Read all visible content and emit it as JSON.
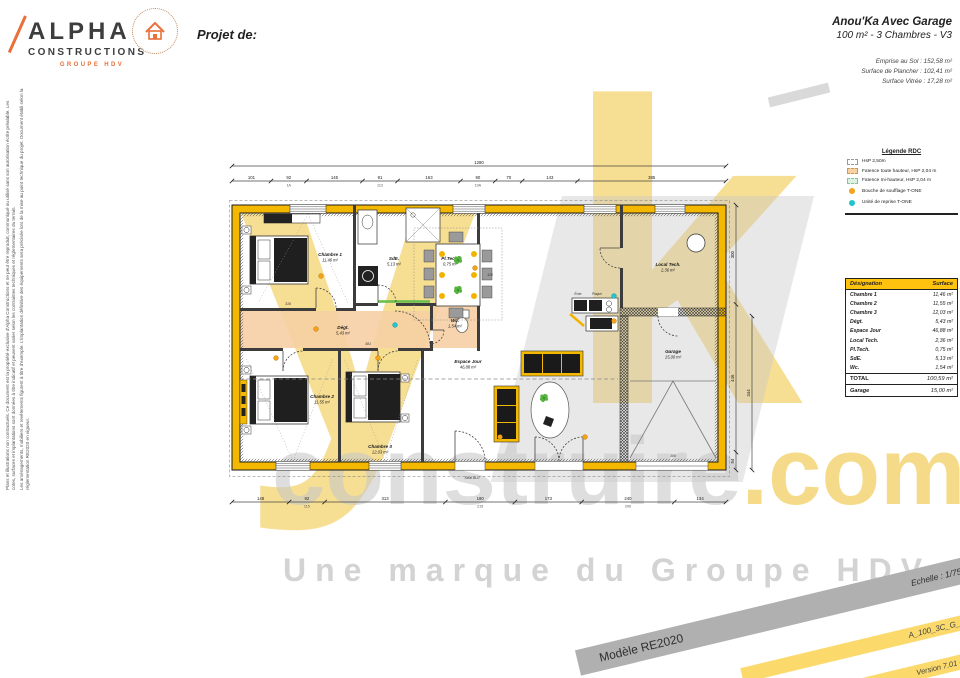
{
  "colors": {
    "wall_yellow": "#f5b800",
    "floor_orange": "#f6cfa4",
    "legend_mint": "#def2e4",
    "table_header": "#ffc20e",
    "supply_orange": "#f5a21b",
    "return_cyan": "#1fc7cd",
    "watermark_yellow": "#f0c43c",
    "watermark_gray": "#c9c9c9",
    "brand_orange": "#e8703a"
  },
  "header": {
    "logo": {
      "line1": "ALPHA",
      "line2": "CONSTRUCTIONS",
      "line3": "GROUPE HDV",
      "stamp_icon": "house"
    },
    "project_label": "Projet de:",
    "title": "Anou'Ka Avec Garage",
    "subtitle": "100 m² - 3 Chambres - V3",
    "metrics": [
      "Emprise au Sol : 152,58 m²",
      "Surface de Plancher : 102,41 m²",
      "Surface Vitrée : 17,28 m²"
    ]
  },
  "side": {
    "legal1": "Plans et illustrations non contractuels. Ce document est la propriété exclusive d'Alpha Constructions et ne peut être reproduit, communiqué ou utilisé sans son autorisation écrite préalable. Les cotes, surfaces et implantations sont données à titre indicatif et peuvent varier selon les contraintes techniques et réglementaires du terrain.",
    "legal2": "Les aménagements, mobiliers et revêtements figurent à titre d'exemple. L'implantation définitive des équipements sera précisée lors de la mise au point technique du projet. Document établi selon la réglementation RE2020 en vigueur."
  },
  "legend": {
    "title": "Légende RDC",
    "items": [
      {
        "swatch": "dash",
        "label": "HsP 2,50m"
      },
      {
        "swatch": "orange",
        "label": "Faïence toute hauteur, HsP 2,04 m"
      },
      {
        "swatch": "mint",
        "label": "Faïence mi-hauteur, HsP 2,04 m"
      },
      {
        "swatch": "dot-orange",
        "label": "Bouche de soufflage T-ONE"
      },
      {
        "swatch": "dot-cyan",
        "label": "Unité de reprise T-ONE"
      }
    ]
  },
  "table": {
    "headers": [
      "Désignation",
      "Surface"
    ],
    "rows": [
      {
        "name": "Chambre 1",
        "value": "11,46 m²"
      },
      {
        "name": "Chambre 2",
        "value": "11,55 m²"
      },
      {
        "name": "Chambre 3",
        "value": "12,03 m²"
      },
      {
        "name": "Dégt.",
        "value": "5,43 m²"
      },
      {
        "name": "Espace Jour",
        "value": "46,88 m²"
      },
      {
        "name": "Local Tech.",
        "value": "2,36 m²"
      },
      {
        "name": "Pl.Tech.",
        "value": "0,75 m²"
      },
      {
        "name": "SdE.",
        "value": "5,13 m²"
      },
      {
        "name": "Wc.",
        "value": "1,54 m²"
      }
    ],
    "total": {
      "label": "TOTAL",
      "value": "100,59 m²"
    },
    "garage": {
      "label": "Garage",
      "value": "15,00 m²"
    }
  },
  "watermark": {
    "big1": "y",
    "big2": "k",
    "mid": "construire",
    "mid_accent": ".com",
    "tagline": "Une marque du Groupe HDV"
  },
  "bands": {
    "model": "Modèle RE2020",
    "scale": "Echelle : 1/75",
    "ref": "A_100_3C_G_V3",
    "version": "Version 7.01 - Mars 2023"
  },
  "plan": {
    "rooms": [
      {
        "name": "Chambre 1",
        "area": "11,46 m²",
        "x": 102,
        "y": 108
      },
      {
        "name": "Chambre 2",
        "area": "11,55 m²",
        "x": 94,
        "y": 250
      },
      {
        "name": "Chambre 3",
        "area": "12,03 m²",
        "x": 152,
        "y": 300
      },
      {
        "name": "Dégt.",
        "area": "5,43 m²",
        "x": 115,
        "y": 181
      },
      {
        "name": "SdE.",
        "area": "5,13 m²",
        "x": 166,
        "y": 112
      },
      {
        "name": "Pl.Tech.",
        "area": "0,75 m²",
        "x": 222,
        "y": 112
      },
      {
        "name": "Wc.",
        "area": "1,54 m²",
        "x": 227,
        "y": 174
      },
      {
        "name": "Espace Jour",
        "area": "46,88 m²",
        "x": 240,
        "y": 215
      },
      {
        "name": "Local Tech.",
        "area": "2,36 m²",
        "x": 440,
        "y": 118
      },
      {
        "name": "Garage",
        "area": "15,00 m²",
        "x": 445,
        "y": 205
      }
    ],
    "windows": [
      {
        "x": 62,
        "w": 36,
        "side": "top"
      },
      {
        "x": 225,
        "w": 32,
        "side": "top"
      },
      {
        "x": 356,
        "w": 32,
        "side": "top"
      },
      {
        "x": 427,
        "w": 30,
        "side": "top"
      },
      {
        "x": 48,
        "w": 34,
        "side": "bottom"
      },
      {
        "x": 141,
        "w": 32,
        "side": "bottom"
      }
    ],
    "chains": [
      {
        "x": 4,
        "y": 18,
        "len": 494,
        "dir": "h",
        "segs": [
          {
            "t": "1280",
            "v": 1280
          }
        ]
      },
      {
        "x": 4,
        "y": 33,
        "len": 494,
        "dir": "h",
        "segs": [
          {
            "t": "101",
            "v": 101
          },
          {
            "t": "92",
            "b": "1A",
            "v": 92
          },
          {
            "t": "145",
            "v": 145
          },
          {
            "t": "91",
            "b": "113",
            "v": 91
          },
          {
            "t": "163",
            "v": 163
          },
          {
            "t": "90",
            "b": "10A",
            "v": 90
          },
          {
            "t": "70",
            "v": 70
          },
          {
            "t": "143",
            "v": 143
          },
          {
            "t": "385",
            "v": 385
          }
        ]
      },
      {
        "x": 4,
        "y": 354,
        "len": 494,
        "dir": "h",
        "segs": [
          {
            "t": "148",
            "v": 148
          },
          {
            "t": "92",
            "b": "115",
            "v": 92
          },
          {
            "t": "313",
            "v": 313
          },
          {
            "t": "180",
            "b": "215",
            "v": 180
          },
          {
            "t": "173",
            "v": 173
          },
          {
            "t": "240",
            "b": "200",
            "v": 240
          },
          {
            "t": "134",
            "v": 134
          }
        ]
      },
      {
        "x": 508,
        "y": 57,
        "len": 265,
        "dir": "v",
        "segs": [
          {
            "t": "300",
            "v": 300
          },
          {
            "t": "446",
            "v": 446
          },
          {
            "t": "54",
            "v": 54
          }
        ]
      },
      {
        "x": 524,
        "y": 168,
        "len": 154,
        "dir": "v",
        "segs": [
          {
            "t": "344",
            "v": 344
          }
        ]
      }
    ],
    "vents": {
      "supply": [
        [
          93,
          128
        ],
        [
          88,
          181
        ],
        [
          48,
          210
        ],
        [
          150,
          210
        ],
        [
          247,
          120
        ],
        [
          272,
          289
        ],
        [
          357,
          289
        ],
        [
          386,
          173
        ]
      ],
      "return": [
        [
          167,
          177
        ],
        [
          386,
          148
        ]
      ]
    },
    "plants": [
      [
        230,
        112
      ],
      [
        230,
        142
      ],
      [
        316,
        250
      ]
    ],
    "annotations": [
      {
        "t": "Seuil ALU",
        "x": 244,
        "y": 331,
        "s": 3.4
      },
      {
        "t": "Évier",
        "x": 350,
        "y": 147,
        "s": 3.2
      },
      {
        "t": "Plaque",
        "x": 369,
        "y": 147,
        "s": 3.2
      },
      {
        "t": "316",
        "x": 60,
        "y": 157,
        "s": 3.6
      },
      {
        "t": "381",
        "x": 140,
        "y": 197,
        "s": 3.6
      },
      {
        "t": "110",
        "x": 262,
        "y": 128,
        "s": 3.6
      },
      {
        "t": "300",
        "x": 445,
        "y": 309,
        "s": 3.8
      }
    ]
  }
}
